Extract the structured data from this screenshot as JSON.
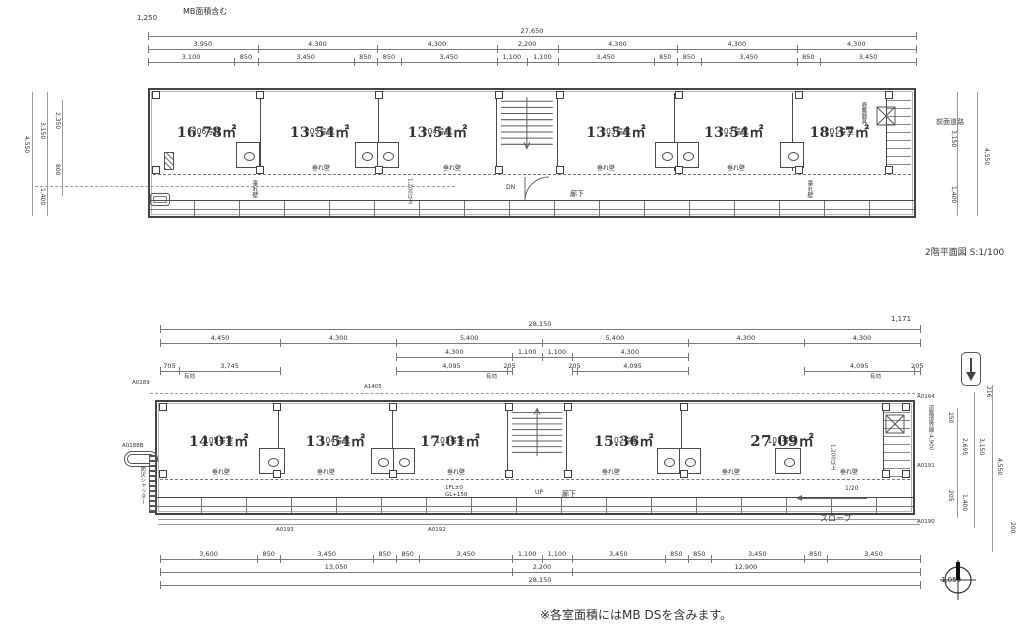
{
  "colors": {
    "line": "#4a4a4a",
    "background": "#ffffff",
    "dim_line": "#787878",
    "muted_text": "#808080"
  },
  "titles": {
    "plan2f_title": "2階平面図 S:1/100",
    "footnote": "※各室面積にはMB DSを含みます。"
  },
  "icons": {
    "north": "north-compass-icon",
    "entry_arrow": "down-arrow-icon",
    "evac": "x-box-icon",
    "bathtub": "bathtub-icon"
  },
  "plan2f": {
    "top_note": "MB面積含む",
    "top_left_dim": "1,250",
    "dim_overall": [
      {
        "v": 27650,
        "t": "27,650"
      }
    ],
    "dim_row2": [
      {
        "v": 3950,
        "t": "3,950"
      },
      {
        "v": 4300,
        "t": "4,300"
      },
      {
        "v": 4300,
        "t": "4,300"
      },
      {
        "v": 2200,
        "t": "2,200"
      },
      {
        "v": 4300,
        "t": "4,300"
      },
      {
        "v": 4300,
        "t": "4,300"
      },
      {
        "v": 4300,
        "t": "4,300"
      }
    ],
    "dim_row3": [
      {
        "v": 3100,
        "t": "3,100"
      },
      {
        "v": 850,
        "t": "850"
      },
      {
        "v": 3450,
        "t": "3,450"
      },
      {
        "v": 850,
        "t": "850"
      },
      {
        "v": 850,
        "t": "850"
      },
      {
        "v": 3450,
        "t": "3,450"
      },
      {
        "v": 1100,
        "t": "1,100"
      },
      {
        "v": 1100,
        "t": "1,100"
      },
      {
        "v": 3450,
        "t": "3,450"
      },
      {
        "v": 850,
        "t": "850"
      },
      {
        "v": 850,
        "t": "850"
      },
      {
        "v": 3450,
        "t": "3,450"
      },
      {
        "v": 850,
        "t": "850"
      },
      {
        "v": 3450,
        "t": "3,450"
      }
    ],
    "rooms": [
      {
        "number": "206号室",
        "area": "16.78㎡"
      },
      {
        "number": "205号室",
        "area": "13.54㎡"
      },
      {
        "number": "204号室",
        "area": "13.54㎡"
      },
      {
        "number": "203号室",
        "area": "13.54㎡"
      },
      {
        "number": "202号室",
        "area": "13.54㎡"
      },
      {
        "number": "201号室",
        "area": "18.37㎡"
      }
    ],
    "stair_label": "DN",
    "corridor": "廊下",
    "tarekabe": "垂れ壁",
    "evac_label": "避難器具",
    "front_road": "前面道路",
    "min_width": "1,200以上",
    "dims_left": {
      "total": "4,550",
      "upper": "3,150",
      "inner_upper": "2,350",
      "inner_lower": "800",
      "lower": "1,400"
    },
    "dims_right": {
      "upper": "3,150",
      "total": "4,550",
      "lower": "1,400"
    }
  },
  "plan1f": {
    "dim_overall": [
      {
        "v": 28150,
        "t": "28,150"
      }
    ],
    "right_overall": "1,171",
    "dim_row2": [
      {
        "v": 4450,
        "t": "4,450"
      },
      {
        "v": 4300,
        "t": "4,300"
      },
      {
        "v": 5400,
        "t": "5,400"
      },
      {
        "v": 5400,
        "t": "5,400"
      },
      {
        "v": 4300,
        "t": "4,300"
      },
      {
        "v": 4300,
        "t": "4,300"
      }
    ],
    "dim_row3": [
      {
        "v": 4450,
        "t": ""
      },
      {
        "v": 4300,
        "t": ""
      },
      {
        "v": 4300,
        "t": "4,300"
      },
      {
        "v": 1100,
        "t": "1,100"
      },
      {
        "v": 1100,
        "t": "1,100"
      },
      {
        "v": 4300,
        "t": "4,300"
      },
      {
        "v": 4300,
        "t": ""
      },
      {
        "v": 4300,
        "t": ""
      }
    ],
    "dim_row4": [
      {
        "v": 705,
        "t": "705"
      },
      {
        "v": 3745,
        "t": "3,745"
      },
      {
        "v": 4300,
        "t": ""
      },
      {
        "v": 4095,
        "t": "4,095"
      },
      {
        "v": 205,
        "t": "205"
      },
      {
        "v": 1100,
        "t": ""
      },
      {
        "v": 1100,
        "t": ""
      },
      {
        "v": 205,
        "t": "205"
      },
      {
        "v": 4095,
        "t": "4,095"
      },
      {
        "v": 4300,
        "t": ""
      },
      {
        "v": 4095,
        "t": "4,095"
      },
      {
        "v": 205,
        "t": "205"
      }
    ],
    "yuko": "有効",
    "rooms": [
      {
        "number": "105号室",
        "area": "14.01㎡"
      },
      {
        "number": "104号室",
        "area": "13.54㎡"
      },
      {
        "number": "103号室",
        "area": "17.01㎡"
      },
      {
        "number": "102号室",
        "area": "15.36㎡"
      },
      {
        "number": "101号室",
        "area": "27.09㎡"
      }
    ],
    "stair_label": "UP",
    "corridor": "廊下",
    "tarekabe": "垂れ壁",
    "min_width": "1,200以上",
    "level_note_1": "1FL±0",
    "level_note_2": "GL+150",
    "shutter": "防災シャッター",
    "slope": "スロープ",
    "slope_ratio": "1/20",
    "boundary": "道路境界線:4,900",
    "refs": {
      "a0189": "A0189",
      "a1405": "A1405",
      "a0188": "A0188B",
      "a0193": "A0193",
      "a0192": "A0192",
      "a0190": "A0190",
      "a0191": "A0191",
      "a0164": "A0164"
    },
    "dims_right": {
      "d216": "216",
      "d250": "250",
      "d2695": "2,695",
      "d3150": "3,150",
      "d4550": "4,550",
      "d205": "205",
      "d1400": "1,400",
      "d200": "200"
    },
    "offset_right": "1,050",
    "dim_bottom1": [
      {
        "v": 3600,
        "t": "3,600"
      },
      {
        "v": 850,
        "t": "850"
      },
      {
        "v": 3450,
        "t": "3,450"
      },
      {
        "v": 850,
        "t": "850"
      },
      {
        "v": 850,
        "t": "850"
      },
      {
        "v": 3450,
        "t": "3,450"
      },
      {
        "v": 1100,
        "t": "1,100"
      },
      {
        "v": 1100,
        "t": "1,100"
      },
      {
        "v": 3450,
        "t": "3,450"
      },
      {
        "v": 850,
        "t": "850"
      },
      {
        "v": 850,
        "t": "850"
      },
      {
        "v": 3450,
        "t": "3,450"
      },
      {
        "v": 850,
        "t": "850"
      },
      {
        "v": 3450,
        "t": "3,450"
      }
    ],
    "dim_bottom2": [
      {
        "v": 13050,
        "t": "13,050"
      },
      {
        "v": 2200,
        "t": "2,200"
      },
      {
        "v": 12900,
        "t": "12,900"
      }
    ],
    "dim_bottom3": [
      {
        "v": 28150,
        "t": "28,150"
      }
    ]
  }
}
